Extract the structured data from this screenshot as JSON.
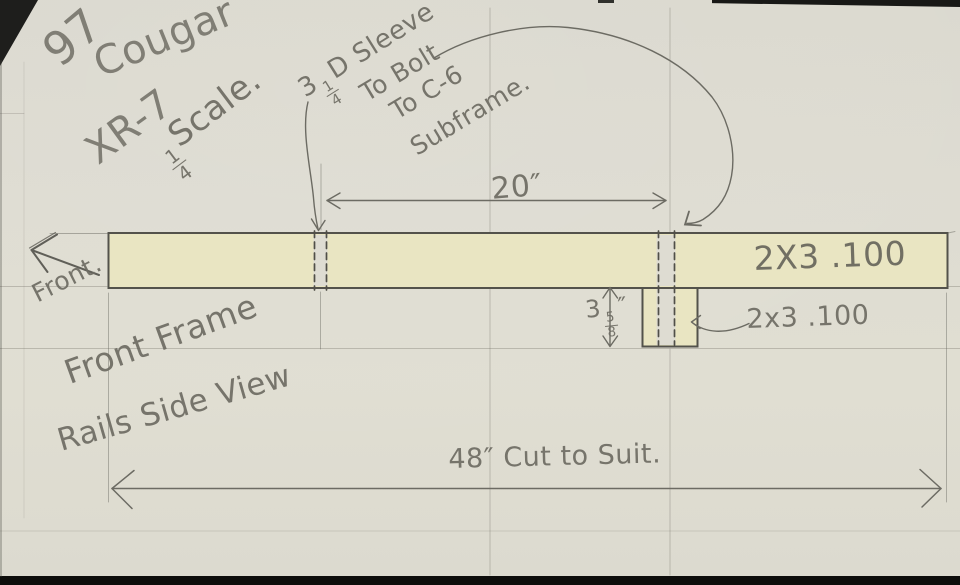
{
  "header": {
    "year": "97",
    "model": "Cougar",
    "trim": "XR-7"
  },
  "scale_note": {
    "num": "1",
    "den": "4",
    "label": "Scale."
  },
  "sleeve_note": {
    "line1_pre": "3",
    "line1_num": "1",
    "line1_den": "4",
    "line1_post": "D Sleeve",
    "line2": "To Bolt",
    "line3": "To C-6",
    "line4": "Subframe."
  },
  "front_label": "Front.",
  "caption": {
    "line1": "Front Frame",
    "line2": "Rails Side View"
  },
  "dims": {
    "sleeve_span": "20″",
    "rail_length": "48″ Cut to Suit.",
    "drop_whole": "3",
    "drop_num": "5",
    "drop_den": "8",
    "drop_unit": "″"
  },
  "labels": {
    "rail_section": "2X3 .100",
    "drop_section": "2x3 .100"
  },
  "colors": {
    "paper": "#dedcd2",
    "highlight": "#e9e5c2",
    "pencil": "#6e6c63",
    "pencil_dark": "#53524b",
    "edge": "#141412"
  }
}
